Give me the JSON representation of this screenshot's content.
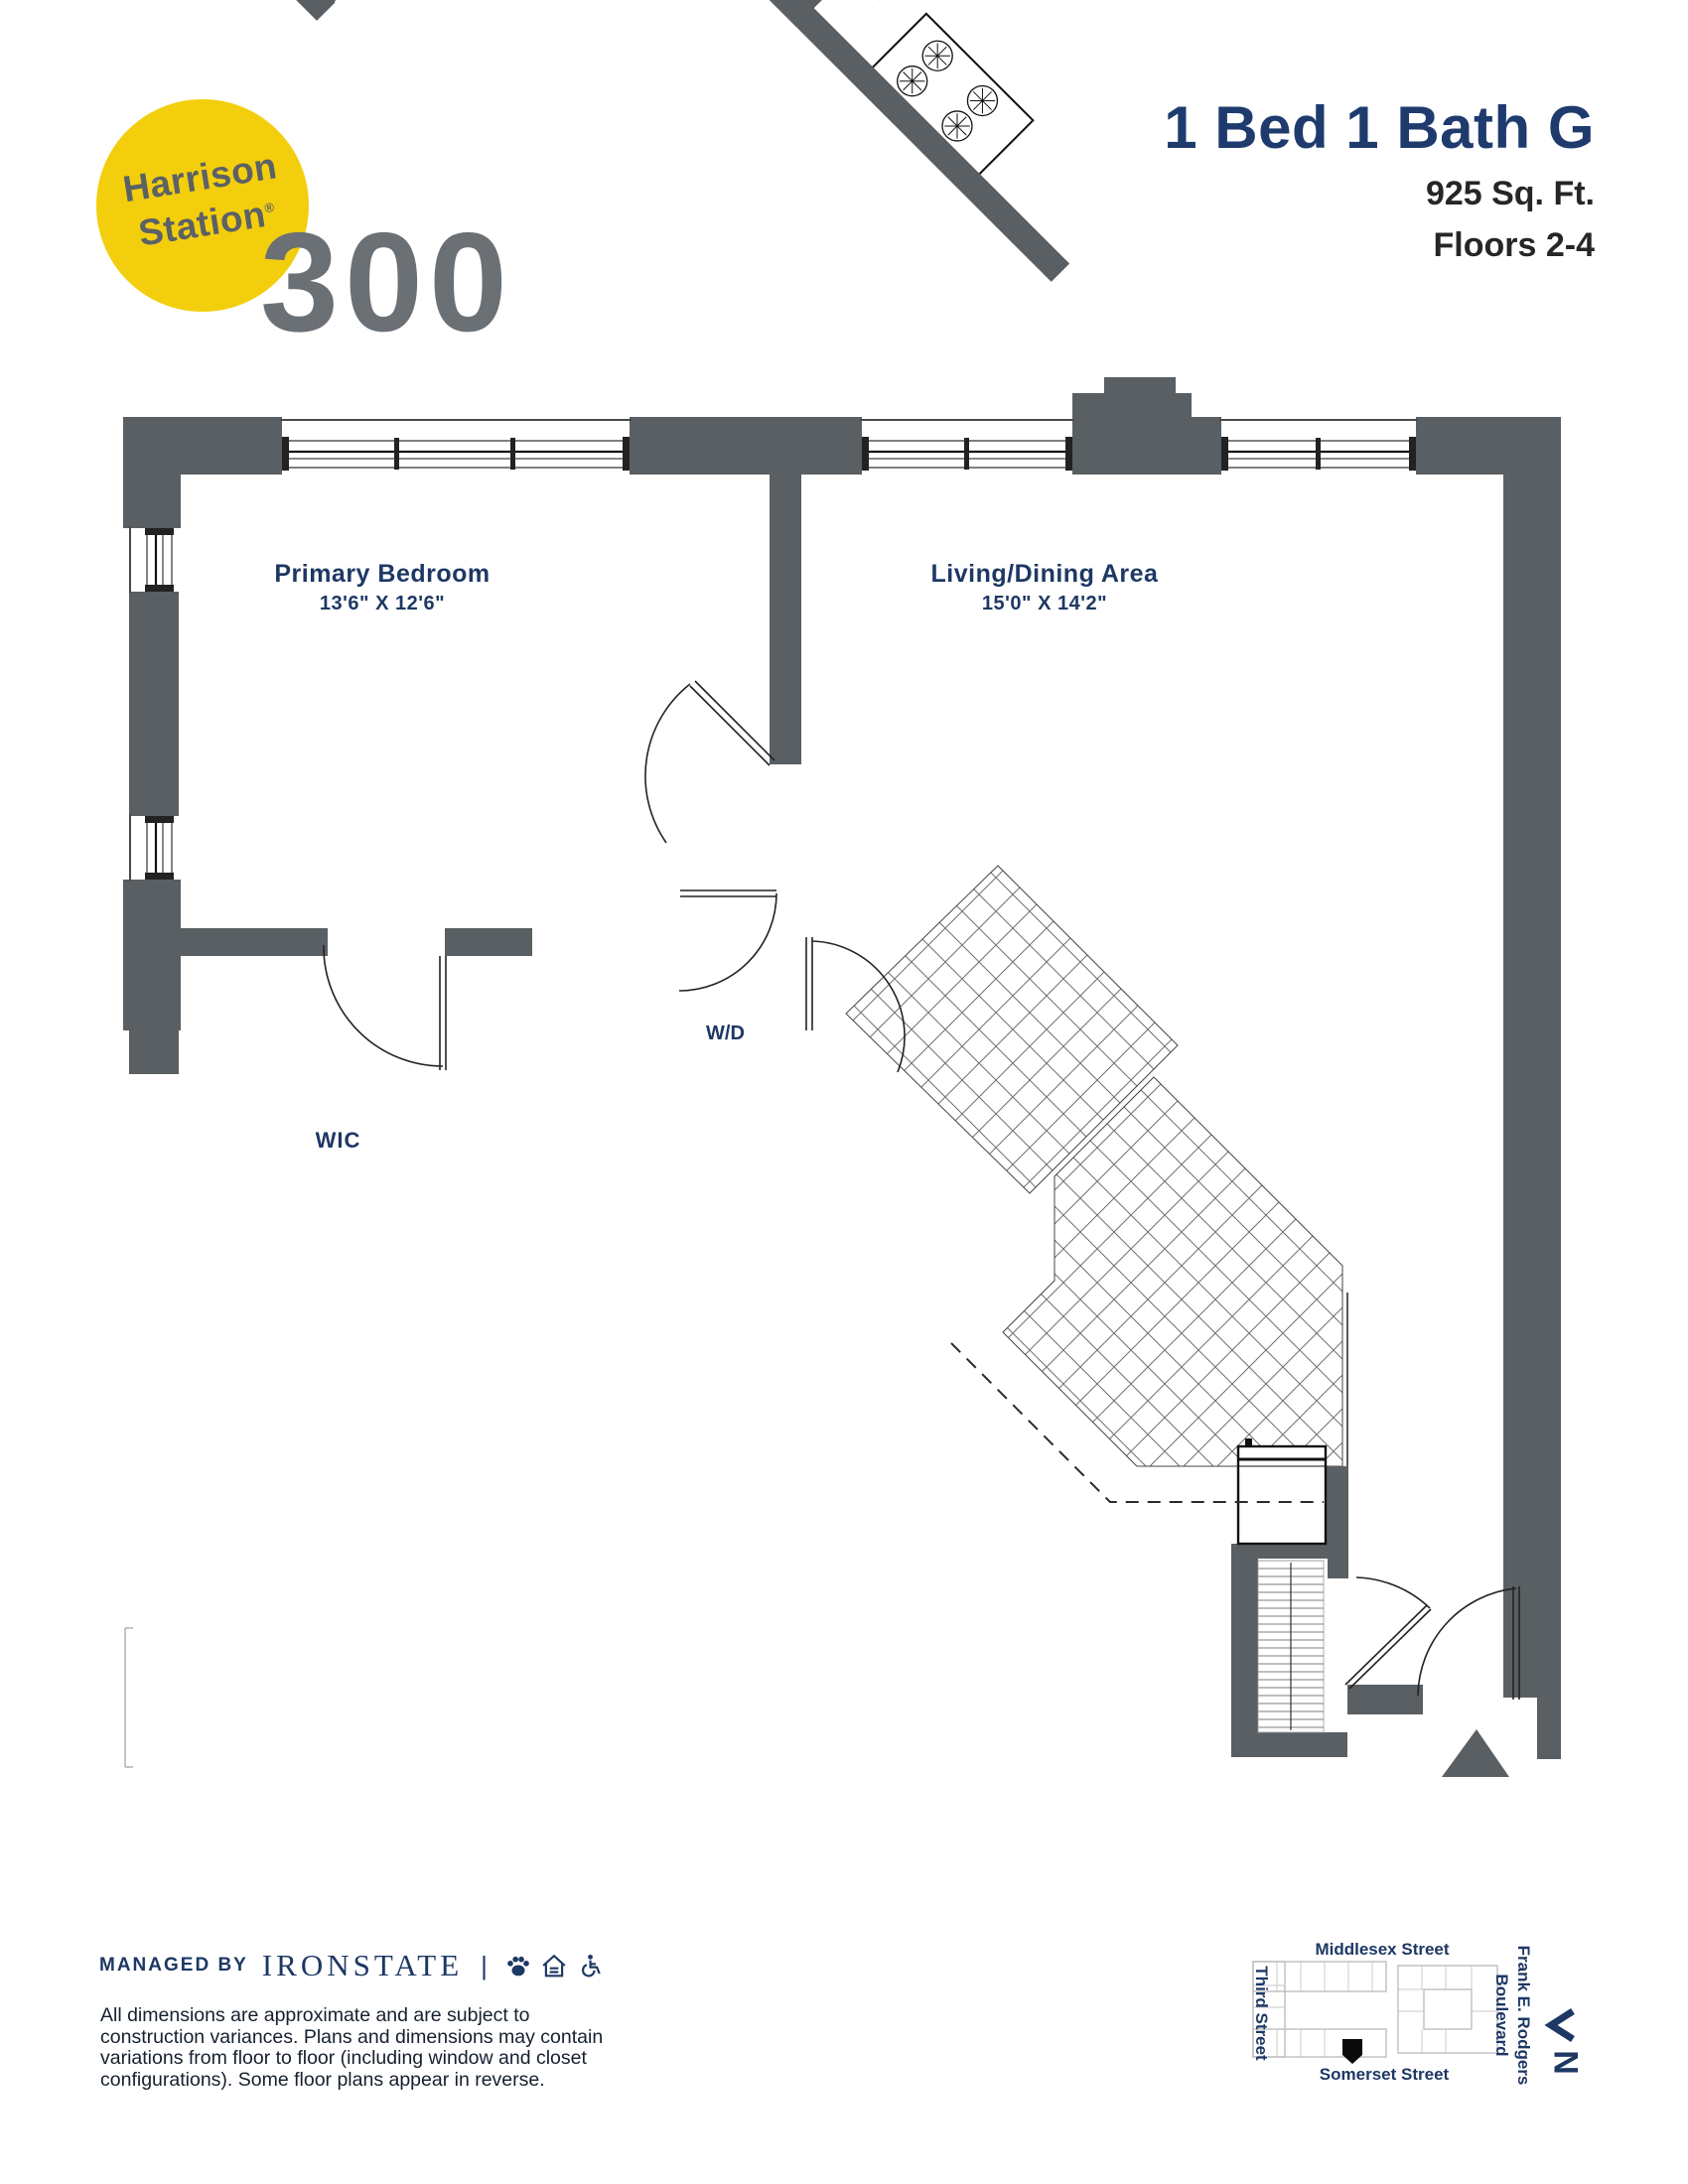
{
  "logo": {
    "name_line1": "Harrison",
    "name_line2": "Station",
    "registered_mark": "®",
    "building_number": "300",
    "circle_color": "#F3CE0D"
  },
  "header": {
    "unit_title": "1 Bed 1 Bath G",
    "area": "925 Sq. Ft.",
    "floors": "Floors 2-4"
  },
  "floorplan": {
    "wall_color": "#5A5F63",
    "label_color": "#1E3864",
    "bedroom": {
      "name": "Primary Bedroom",
      "dimensions": "13'6\" X 12'6\""
    },
    "living": {
      "name": "Living/Dining Area",
      "dimensions": "15'0\" X 14'2\""
    },
    "wic": {
      "label": "WIC"
    },
    "washer_dryer": {
      "label": "W/D"
    }
  },
  "footer": {
    "managed_by": "MANAGED BY",
    "company": "IRONSTATE",
    "divider": "|",
    "disclaimer": {
      "line1": "All dimensions are approximate and are subject to",
      "line2": "construction variances. Plans and dimensions may contain",
      "line3": "variations from floor to floor (including window and closet",
      "line4": "configurations). Some floor plans appear in reverse."
    }
  },
  "map": {
    "street_top": "Middlesex Street",
    "street_left": "Third Street",
    "street_right_line1": "Frank E. Rodgers",
    "street_right_line2": "Boulevard",
    "street_bottom": "Somerset Street",
    "compass_label": "N"
  }
}
